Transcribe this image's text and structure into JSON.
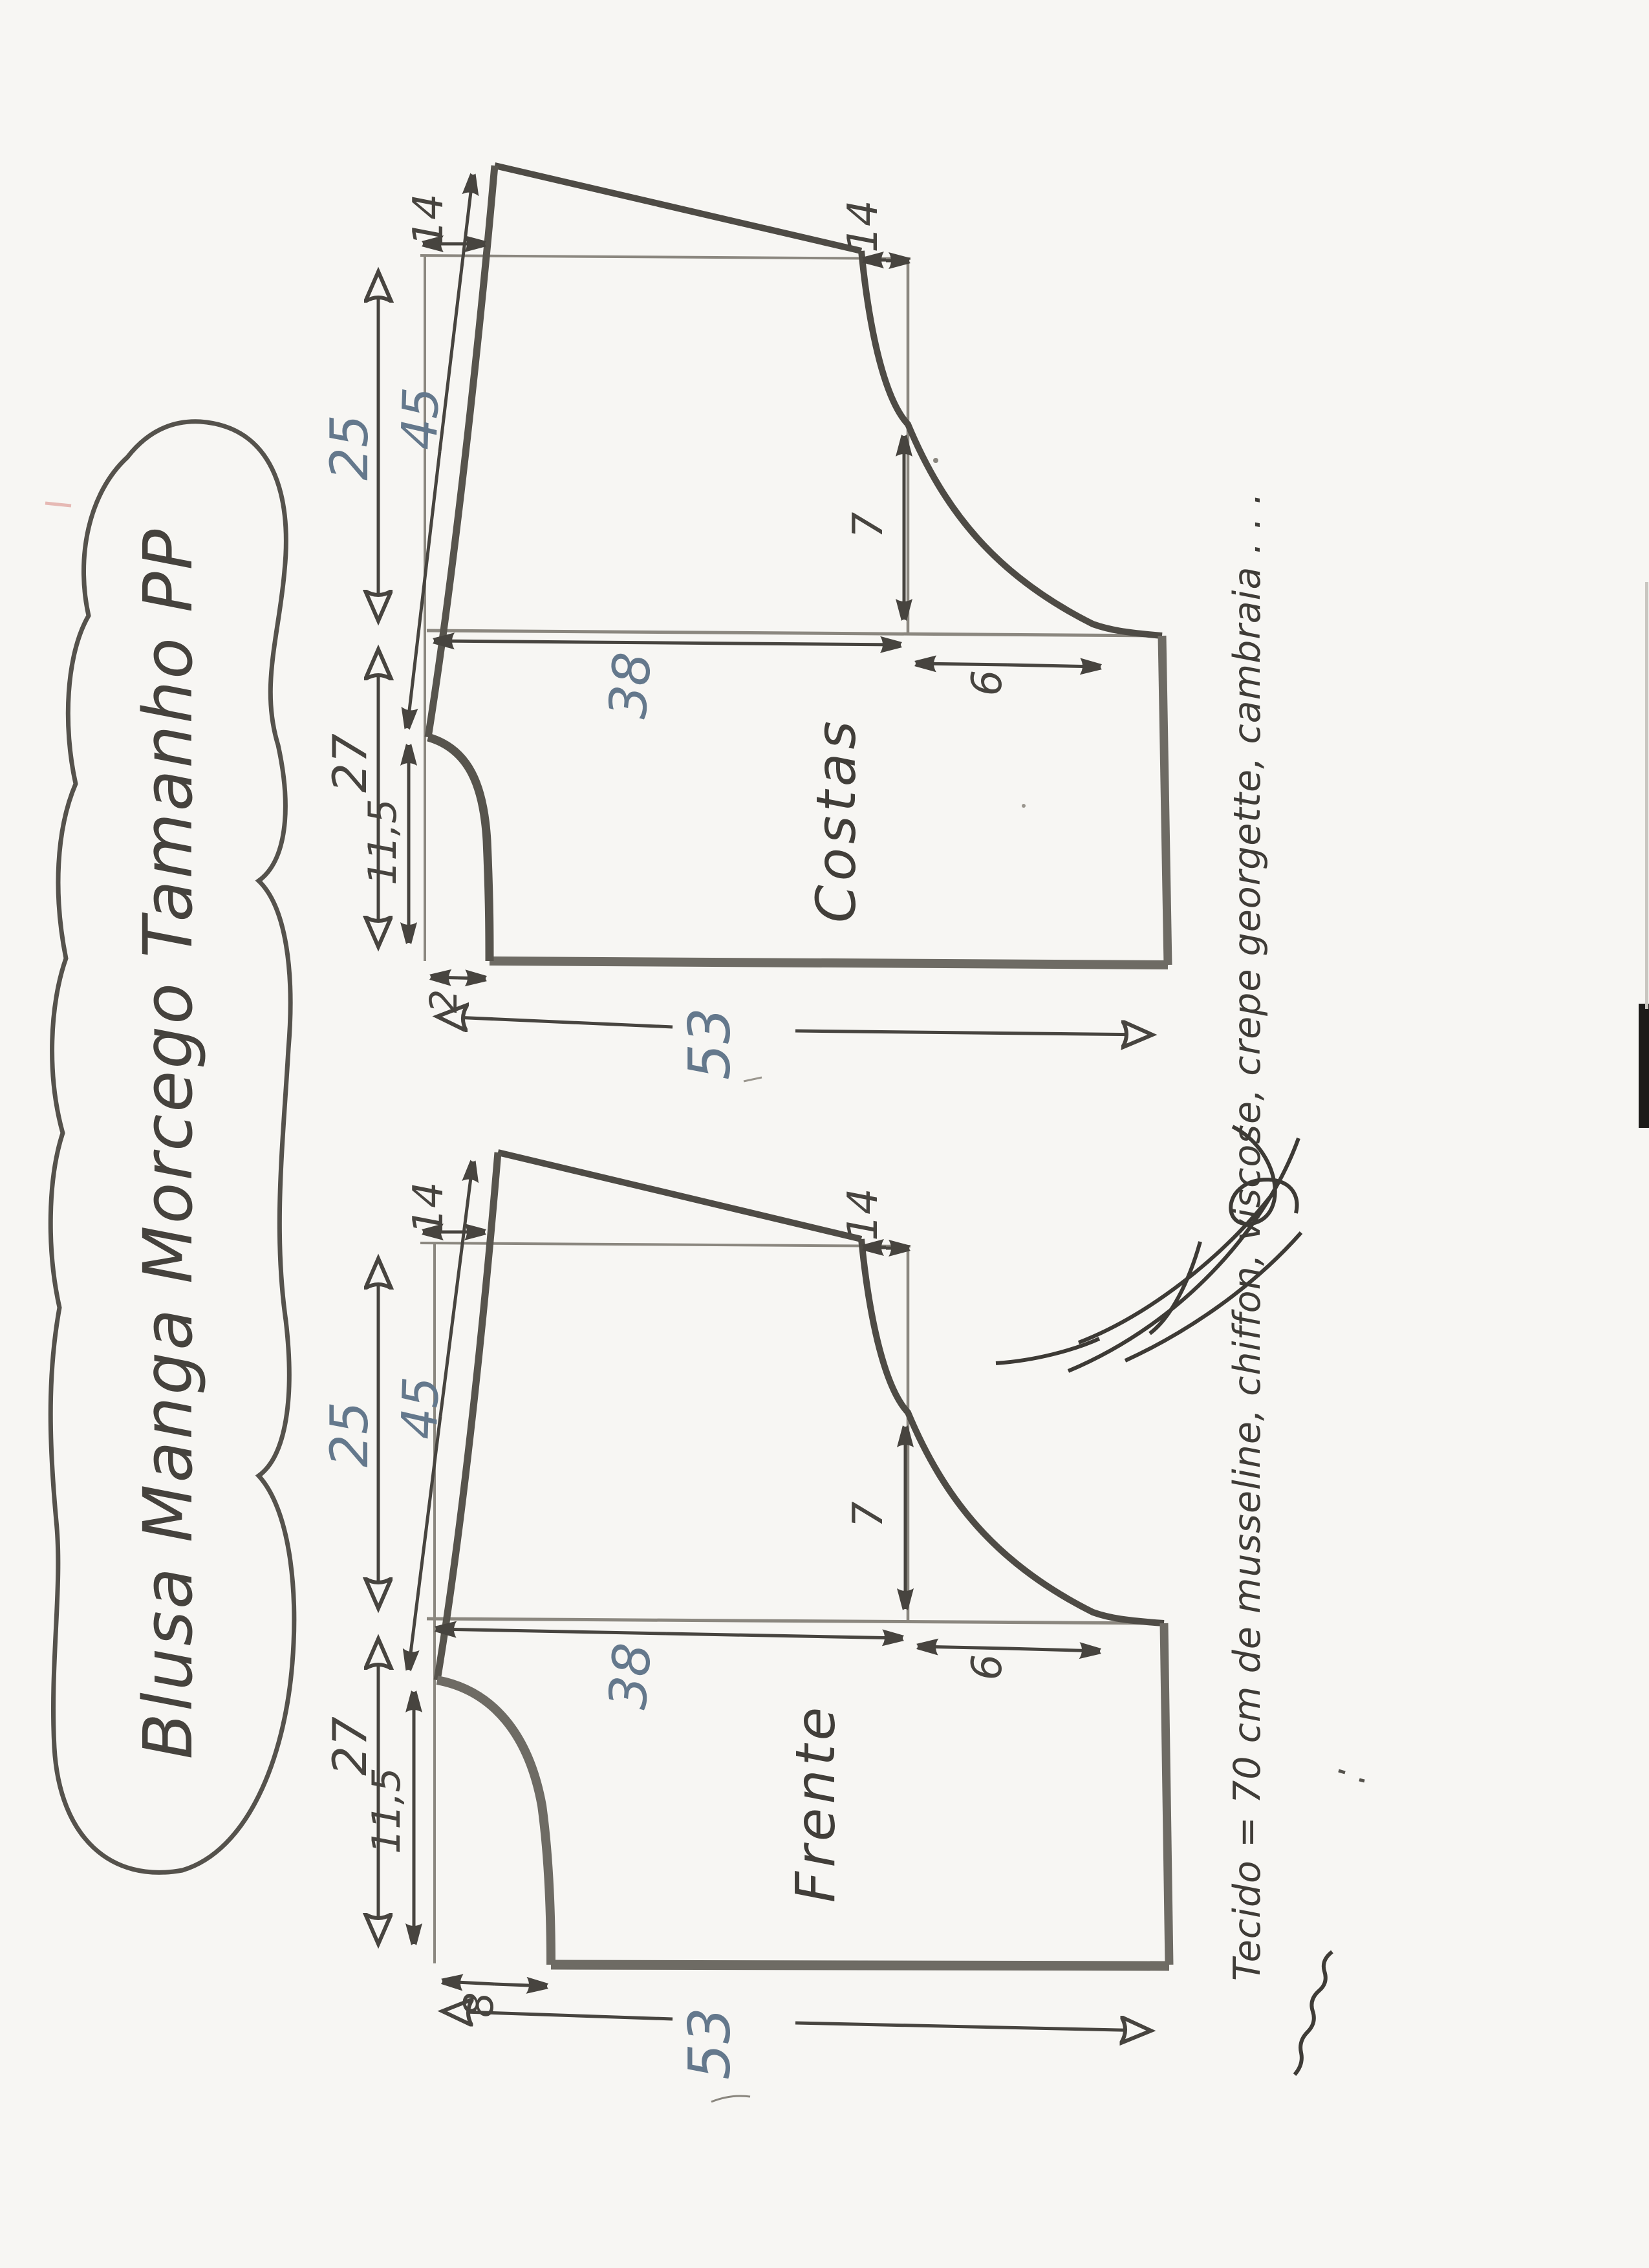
{
  "page": {
    "kind": "scanned hand-drawn sewing pattern sheet",
    "paper_color": "#f7f6f3",
    "ink_dark": "#47443f",
    "ink_mid": "#716d66",
    "ink_blue": "#64788c",
    "artifact_color": "#1c1b19"
  },
  "title_bubble": {
    "text": "Blusa Manga Morcego Tamanho PP"
  },
  "fabric_note": {
    "text": "Tecido = 70 cm   de   musseline, chiffon, viscose, crepe georgette, cambraia . . ."
  },
  "signature": {
    "present": "handwritten cursive signature"
  },
  "pieces": {
    "costas": {
      "label": "Costas",
      "shoulder_offset_left": "14",
      "shoulder_offset_right": "14",
      "sleeve_edge_length": "45",
      "sleeve_opening": "25",
      "armhole_depth": "7",
      "bust_width": "38",
      "side_offset": "6",
      "body_side": "27",
      "neck_width": "11,5",
      "neck_drop": "2",
      "total_length": "53"
    },
    "frente": {
      "label": "Frente",
      "shoulder_offset_left": "14",
      "shoulder_offset_right": "14",
      "sleeve_edge_length": "45",
      "sleeve_opening": "25",
      "armhole_depth": "7",
      "bust_width": "38",
      "side_offset": "6",
      "body_side": "27",
      "neck_width": "11,5",
      "neck_drop": "8",
      "total_length": "53"
    }
  }
}
